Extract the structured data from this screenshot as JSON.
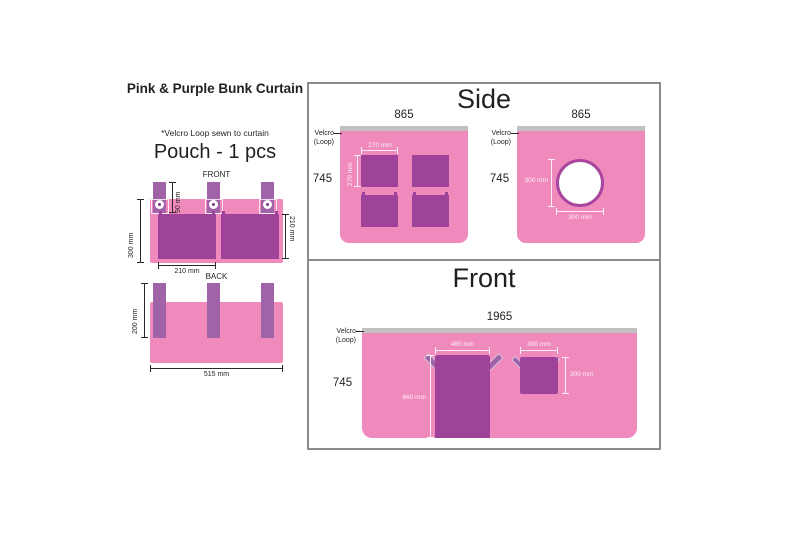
{
  "page": {
    "title": "Pink & Purple Bunk Curtain",
    "note": "*Velcro Loop sewn to curtain"
  },
  "pouch": {
    "heading": "Pouch - 1 pcs",
    "front": {
      "label": "FRONT",
      "tab_height": "90 mm",
      "side_height": "300 mm",
      "pocket_depth": "210 mm",
      "pocket_width": "210 mm"
    },
    "back": {
      "label": "BACK",
      "strap_height": "200 mm",
      "width": "515 mm"
    }
  },
  "side": {
    "title": "Side",
    "velcro_line1": "Velcro",
    "velcro_line2": "(Loop)",
    "window_panel": {
      "top_width": "865",
      "height": "745",
      "window_width": "270 mm",
      "window_height": "270 mm"
    },
    "hole_panel": {
      "top_width": "865",
      "height": "745",
      "hole_height": "300 mm",
      "hole_width": "300 mm"
    }
  },
  "front": {
    "title": "Front",
    "velcro_line1": "Velcro",
    "velcro_line2": "(Loop)",
    "top_width": "1965",
    "height": "745",
    "door": {
      "width": "480 mm",
      "height": "660 mm"
    },
    "window": {
      "width": "300 mm",
      "height": "300 mm"
    }
  },
  "colors": {
    "pink": "#f08abc",
    "purple": "#9e4399",
    "tab_purple": "#a163a8",
    "velcro_gray": "#c2c0c1",
    "frame_gray": "#8a8a8a"
  }
}
